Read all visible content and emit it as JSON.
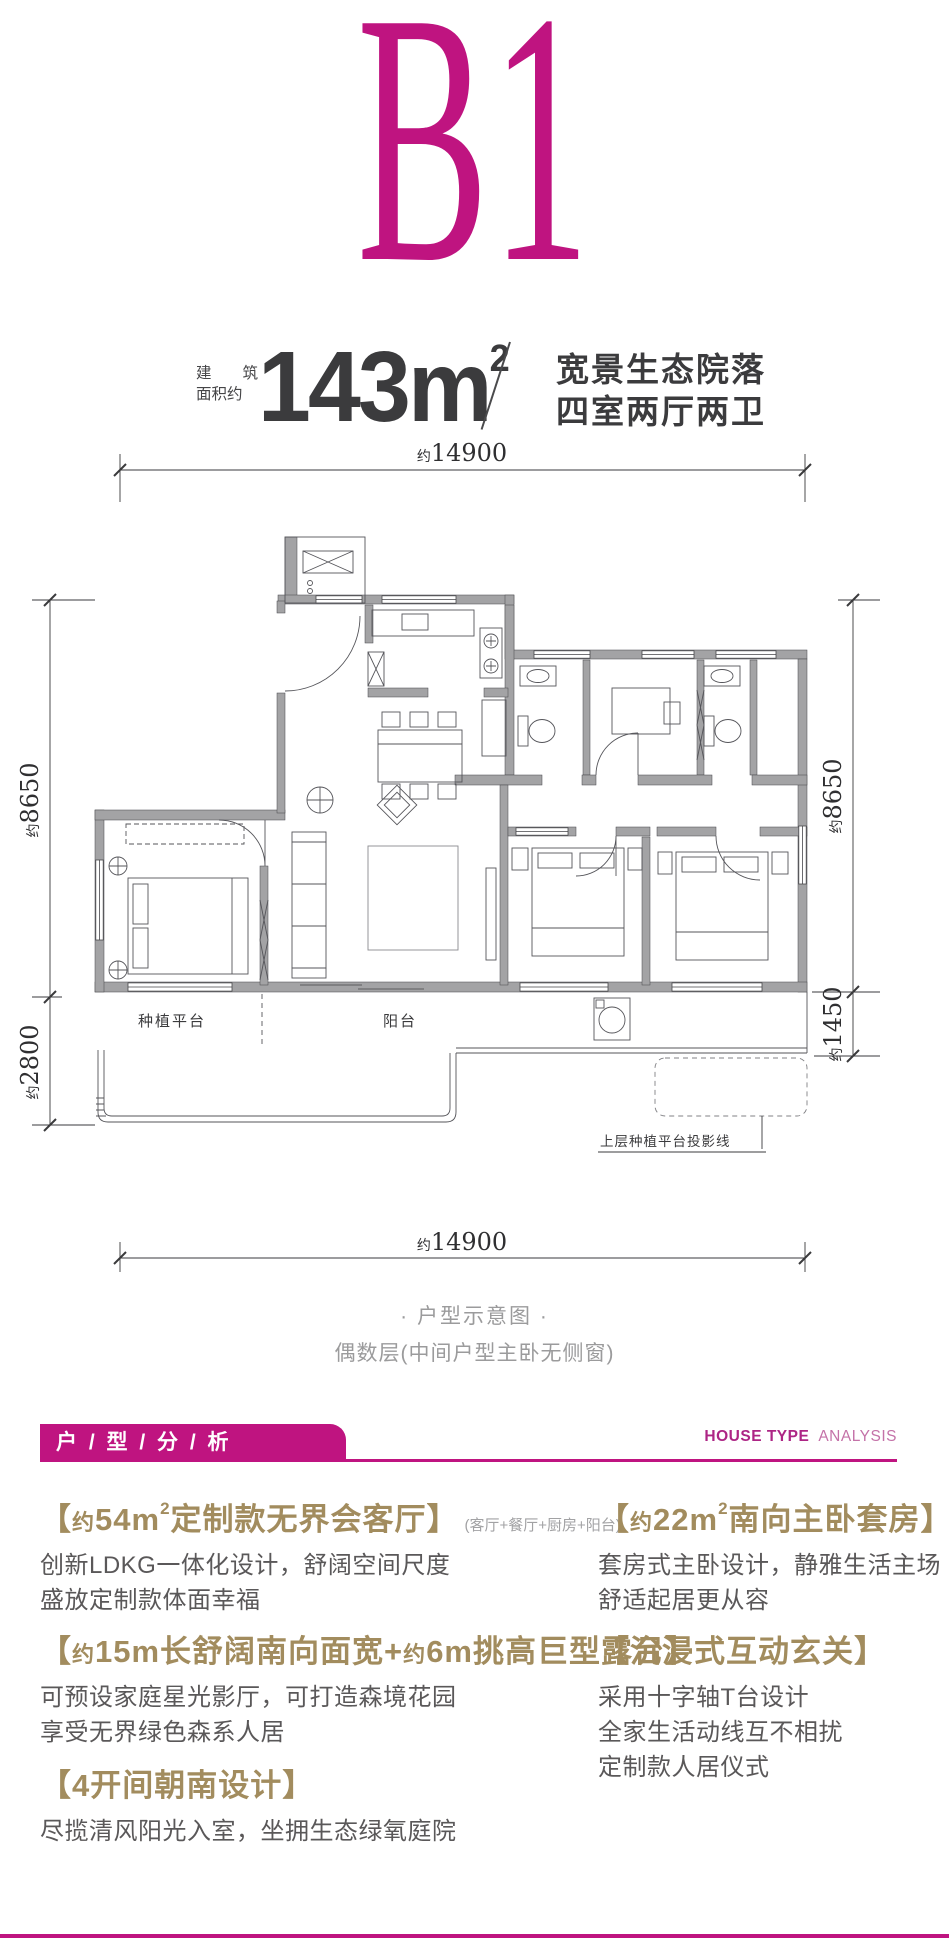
{
  "colors": {
    "accent_magenta": "#bf1480",
    "gold": "#a28c5e",
    "body_gray": "#5a5859",
    "caption_gray": "#9b9b9c",
    "title_dark": "#3b3b3d"
  },
  "header": {
    "plan_code": "B1"
  },
  "spec": {
    "area_label_line1": [
      "建",
      "筑"
    ],
    "area_label_line2": "面积约",
    "area_value": "143m",
    "area_sup": "2",
    "desc_line1": "宽景生态院落",
    "desc_line2": "四室两厅两卫"
  },
  "floorplan": {
    "dims": {
      "top": {
        "a": "约",
        "v": "14900"
      },
      "bottom": {
        "a": "约",
        "v": "14900"
      },
      "left_upper": {
        "a": "约",
        "v": "8650"
      },
      "left_lower": {
        "a": "约",
        "v": "2800"
      },
      "right_upper": {
        "a": "约",
        "v": "8650"
      },
      "right_lower": {
        "a": "约",
        "v": "1450"
      }
    },
    "labels": {
      "planting_platform": "种植平台",
      "balcony": "阳台",
      "projection": "上层种植平台投影线"
    },
    "caption_line1": "· 户型示意图 ·",
    "caption_line2": "偶数层(中间户型主卧无侧窗)"
  },
  "analysis": {
    "bar_label": "户 / 型 / 分 / 析",
    "en_bold": "HOUSE TYPE",
    "en_light": "ANALYSIS",
    "left": [
      {
        "head": [
          {
            "t": "【",
            "c": "h"
          },
          {
            "t": "约",
            "c": "hs"
          },
          {
            "t": "54m",
            "c": "h"
          },
          {
            "t": "2",
            "c": "hsup"
          },
          {
            "t": "定制款无界会客厅】",
            "c": "h"
          },
          {
            "t": "(客厅+餐厅+厨房+阳台)",
            "c": "hnote"
          }
        ],
        "lines": [
          "创新LDKG一体化设计，舒阔空间尺度",
          "盛放定制款体面幸福"
        ]
      },
      {
        "head": [
          {
            "t": "【",
            "c": "h"
          },
          {
            "t": "约",
            "c": "hs"
          },
          {
            "t": "15m长舒阔南向面宽+",
            "c": "h"
          },
          {
            "t": "约",
            "c": "hs"
          },
          {
            "t": "6m挑高巨型露台】",
            "c": "h"
          }
        ],
        "lines": [
          "可预设家庭星光影厅，可打造森境花园",
          "享受无界绿色森系人居"
        ]
      },
      {
        "head": [
          {
            "t": "【4开间朝南设计】",
            "c": "h"
          }
        ],
        "lines": [
          "尽揽清风阳光入室，坐拥生态绿氧庭院"
        ]
      }
    ],
    "right": [
      {
        "head": [
          {
            "t": "【",
            "c": "h"
          },
          {
            "t": "约",
            "c": "hs"
          },
          {
            "t": "22m",
            "c": "h"
          },
          {
            "t": "2",
            "c": "hsup"
          },
          {
            "t": "南向主卧套房】",
            "c": "h"
          }
        ],
        "lines": [
          "套房式主卧设计，静雅生活主场",
          "舒适起居更从容"
        ]
      },
      {
        "head": [
          {
            "t": "【沉浸式互动玄关】",
            "c": "h"
          }
        ],
        "lines": [
          "采用十字轴T台设计",
          "全家生活动线互不相扰",
          "定制款人居仪式"
        ]
      }
    ]
  }
}
